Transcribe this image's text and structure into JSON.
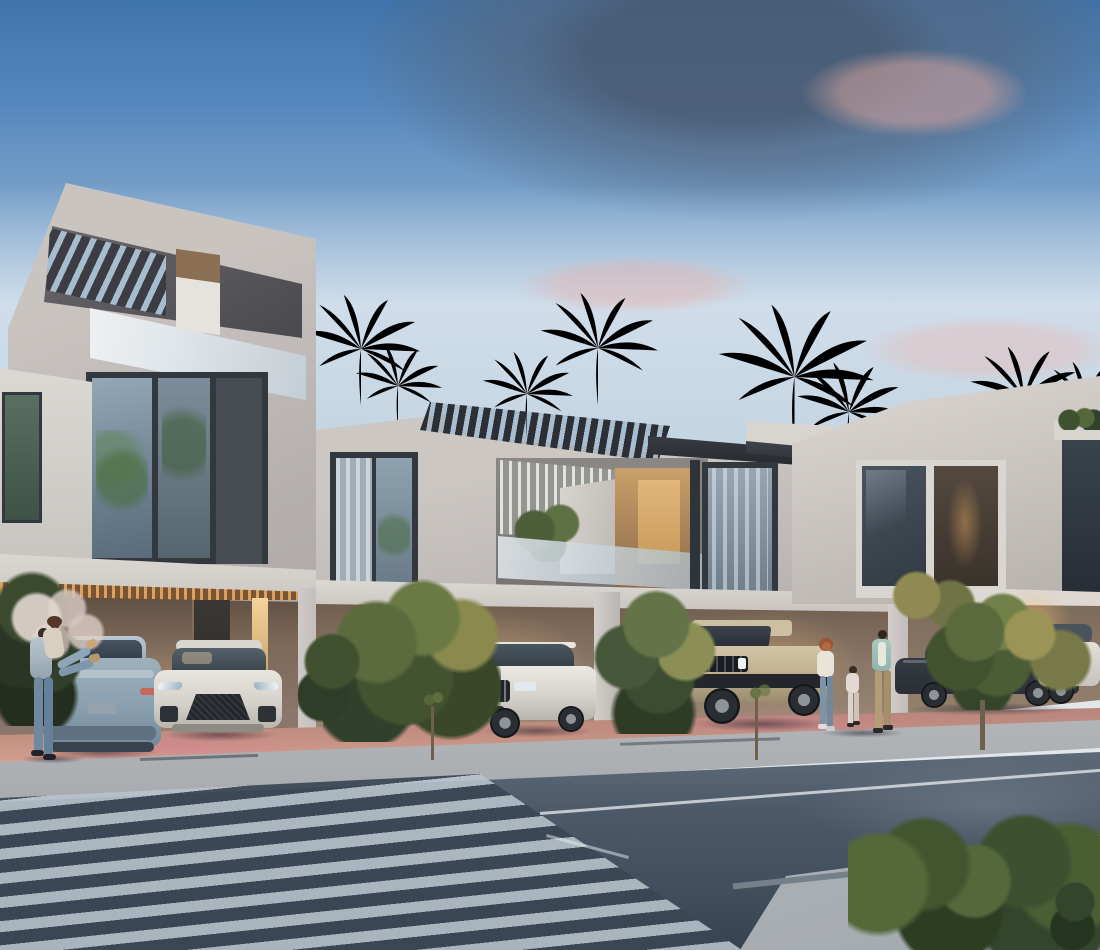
{
  "scene": {
    "type": "architectural-render",
    "description": "Twilight 3D rendering of a row of modern two-storey townhouses with a taller corner tower, rooftop pergolas, glass balconies, lit carports with parked cars, palm trees, pedestrians, and a street with a diagonal striped crosswalk in the foreground",
    "time_of_day": "dusk"
  },
  "palette": {
    "sky_top": "#3f74ab",
    "sky_mid": "#7fa6cc",
    "sky_low": "#c9d9e4",
    "sky_horizon": "#dfe6ea",
    "cloud_dark": "#5a697d",
    "cloud_pink": "#e3b3ab",
    "wall_light": "#cdc8c4",
    "wall_mid": "#b5b0ae",
    "fascia_light": "#ddd9d5",
    "frame_dark": "#33383e",
    "accent_tan": "#8a6f52",
    "glass_dark": "#3c4650",
    "glass_sky": "#9fb2c1",
    "glass_balustrade": "#dfe5e9",
    "interior_warm": "#e2b679",
    "soffit_glow": "#d9a25e",
    "carport_wall": "#7d695a",
    "carport_dark": "#5e4d40",
    "apron_terracotta": "#c49082",
    "sidewalk": "#b2b5b8",
    "road_dark": "#414e5d",
    "road_light": "#5d6a78",
    "stripe_light": "#b9c3cb",
    "plaza": "#aeb3b7",
    "lane_line": "#e8edf1",
    "foliage_dark": "#31422a",
    "foliage_mid": "#55683c",
    "foliage_yellow": "#b0a05c",
    "trunk": "#6f5f4e",
    "car_blue": "#9db0be",
    "car_white": "#e8e5df",
    "car_beige": "#bfae8e",
    "car_dark": "#2b3037",
    "taillight": "#c26a60",
    "headlight": "#eef4f6"
  },
  "objects": {
    "buildings": [
      {
        "name": "left-tower",
        "storeys": 3,
        "features": [
          "slanted concrete roof frame",
          "rooftop pergola slats",
          "glass balustrade",
          "tan accent panel",
          "large corner window",
          "lit carport with wood-slat soffit"
        ]
      },
      {
        "name": "middle-townhouse",
        "storeys": 2,
        "features": [
          "rooftop pergola canopies",
          "louvered balcony screen",
          "glass balustrade",
          "warm interior lighting",
          "carports"
        ]
      },
      {
        "name": "right-townhouse",
        "storeys": 2,
        "features": [
          "tall blank gable wall",
          "dark roof overhang",
          "dark framed windows",
          "carport"
        ]
      }
    ],
    "cars": [
      {
        "name": "suv-coupe-rear",
        "color": "light steel blue",
        "location": "left carport"
      },
      {
        "name": "compact-crossover-front",
        "color": "white",
        "location": "left carport"
      },
      {
        "name": "luxury-suv",
        "color": "white",
        "location": "middle carport"
      },
      {
        "name": "electric-pickup",
        "color": "sand beige",
        "location": "middle carport"
      },
      {
        "name": "sedan",
        "color": "dark grey",
        "location": "right carport, behind clipped tree"
      },
      {
        "name": "suv-partial",
        "color": "white",
        "location": "far right edge"
      }
    ],
    "people": [
      {
        "name": "embracing-couple",
        "count": 2,
        "location": "left, beside the parked cars"
      },
      {
        "name": "walking-family",
        "count": 3,
        "members": [
          "mother",
          "child",
          "father"
        ],
        "location": "sidewalk in front of the beige pickup"
      }
    ],
    "vegetation": {
      "palm_trees": 8,
      "bushes": [
        "round bush",
        "fan-palm bush",
        "clipped round tree",
        "hedge row",
        "corner bush"
      ],
      "street_saplings": 2
    },
    "street": {
      "features": [
        "terracotta driveway apron",
        "concrete sidewalk with joints",
        "asphalt road",
        "diagonal striped crosswalk",
        "white lane line",
        "paved corner plaza",
        "foreground hedge"
      ]
    }
  }
}
